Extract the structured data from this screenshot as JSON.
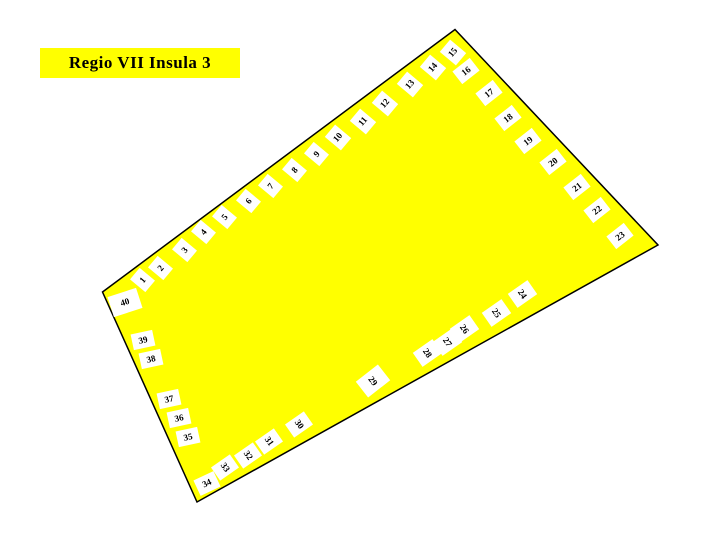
{
  "title": "Regio VII Insula 3",
  "colors": {
    "page_bg": "#FFFFFF",
    "insula_fill": "#FFFF00",
    "insula_outline": "#000000",
    "marker_bg": "#FFFFFF",
    "marker_text": "#000000",
    "title_bg": "#FFFF00",
    "title_text": "#000000"
  },
  "map": {
    "entrances": [
      {
        "label": "1",
        "x": 142,
        "y": 280,
        "rot": -50,
        "w": 15,
        "h": 20
      },
      {
        "label": "2",
        "x": 160,
        "y": 268,
        "rot": -50,
        "w": 15,
        "h": 20
      },
      {
        "label": "3",
        "x": 184,
        "y": 250,
        "rot": -50,
        "w": 15,
        "h": 20
      },
      {
        "label": "4",
        "x": 203,
        "y": 232,
        "rot": -50,
        "w": 15,
        "h": 20
      },
      {
        "label": "5",
        "x": 224,
        "y": 217,
        "rot": -50,
        "w": 15,
        "h": 20
      },
      {
        "label": "6",
        "x": 248,
        "y": 201,
        "rot": -50,
        "w": 15,
        "h": 20
      },
      {
        "label": "7",
        "x": 270,
        "y": 186,
        "rot": -50,
        "w": 15,
        "h": 20
      },
      {
        "label": "8",
        "x": 294,
        "y": 170,
        "rot": -50,
        "w": 15,
        "h": 20
      },
      {
        "label": "9",
        "x": 316,
        "y": 154,
        "rot": -50,
        "w": 15,
        "h": 20
      },
      {
        "label": "10",
        "x": 338,
        "y": 137,
        "rot": -50,
        "w": 16,
        "h": 21
      },
      {
        "label": "11",
        "x": 363,
        "y": 121,
        "rot": -50,
        "w": 16,
        "h": 21
      },
      {
        "label": "12",
        "x": 385,
        "y": 103,
        "rot": -50,
        "w": 16,
        "h": 21
      },
      {
        "label": "13",
        "x": 410,
        "y": 84,
        "rot": -50,
        "w": 16,
        "h": 21
      },
      {
        "label": "14",
        "x": 433,
        "y": 67,
        "rot": -50,
        "w": 16,
        "h": 21
      },
      {
        "label": "15",
        "x": 453,
        "y": 52,
        "rot": -50,
        "w": 16,
        "h": 21
      },
      {
        "label": "16",
        "x": 466,
        "y": 71,
        "rot": -38,
        "w": 22,
        "h": 16
      },
      {
        "label": "17",
        "x": 489,
        "y": 93,
        "rot": -38,
        "w": 22,
        "h": 16
      },
      {
        "label": "18",
        "x": 508,
        "y": 118,
        "rot": -38,
        "w": 22,
        "h": 16
      },
      {
        "label": "19",
        "x": 528,
        "y": 141,
        "rot": -38,
        "w": 22,
        "h": 16
      },
      {
        "label": "20",
        "x": 553,
        "y": 162,
        "rot": -38,
        "w": 22,
        "h": 16
      },
      {
        "label": "21",
        "x": 577,
        "y": 187,
        "rot": -38,
        "w": 22,
        "h": 16
      },
      {
        "label": "22",
        "x": 597,
        "y": 210,
        "rot": -38,
        "w": 22,
        "h": 16
      },
      {
        "label": "23",
        "x": 620,
        "y": 236,
        "rot": -38,
        "w": 22,
        "h": 16
      },
      {
        "label": "24",
        "x": 522,
        "y": 294,
        "rot": 55,
        "w": 17,
        "h": 24
      },
      {
        "label": "25",
        "x": 496,
        "y": 313,
        "rot": 55,
        "w": 17,
        "h": 24
      },
      {
        "label": "26",
        "x": 464,
        "y": 329,
        "rot": 55,
        "w": 17,
        "h": 24
      },
      {
        "label": "27",
        "x": 447,
        "y": 342,
        "rot": 55,
        "w": 17,
        "h": 24
      },
      {
        "label": "28",
        "x": 427,
        "y": 353,
        "rot": 55,
        "w": 17,
        "h": 24
      },
      {
        "label": "29",
        "x": 373,
        "y": 381,
        "rot": 52,
        "w": 20,
        "h": 28
      },
      {
        "label": "30",
        "x": 299,
        "y": 424,
        "rot": 55,
        "w": 16,
        "h": 23
      },
      {
        "label": "31",
        "x": 269,
        "y": 441,
        "rot": 55,
        "w": 16,
        "h": 23
      },
      {
        "label": "32",
        "x": 248,
        "y": 455,
        "rot": 55,
        "w": 16,
        "h": 23
      },
      {
        "label": "33",
        "x": 225,
        "y": 467,
        "rot": 55,
        "w": 16,
        "h": 23
      },
      {
        "label": "34",
        "x": 207,
        "y": 483,
        "rot": -25,
        "w": 22,
        "h": 17
      },
      {
        "label": "35",
        "x": 188,
        "y": 437,
        "rot": -12,
        "w": 22,
        "h": 16
      },
      {
        "label": "36",
        "x": 179,
        "y": 418,
        "rot": -12,
        "w": 22,
        "h": 16
      },
      {
        "label": "37",
        "x": 169,
        "y": 399,
        "rot": -12,
        "w": 22,
        "h": 16
      },
      {
        "label": "38",
        "x": 151,
        "y": 359,
        "rot": -12,
        "w": 22,
        "h": 16
      },
      {
        "label": "39",
        "x": 143,
        "y": 340,
        "rot": -12,
        "w": 22,
        "h": 16
      },
      {
        "label": "40",
        "x": 125,
        "y": 302,
        "rot": -18,
        "w": 30,
        "h": 21
      }
    ]
  }
}
